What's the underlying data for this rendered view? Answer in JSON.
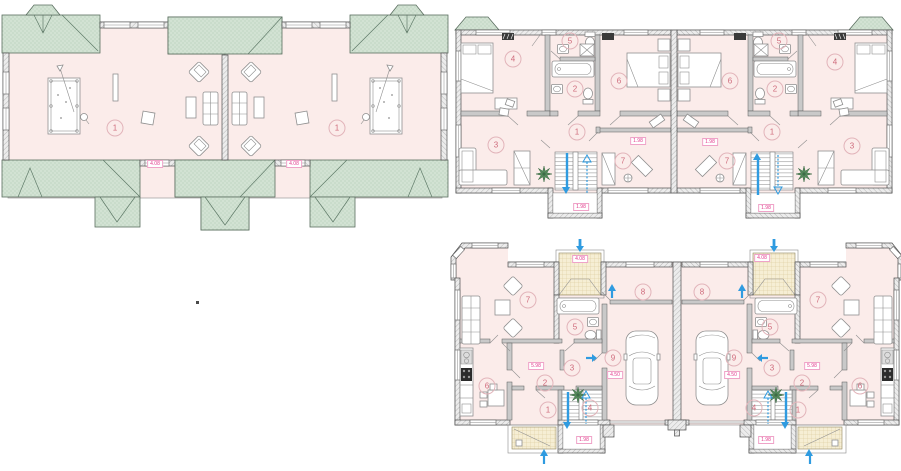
{
  "colors": {
    "floor_pink": "#fbecea",
    "roof_green": "#d2e2d3",
    "porch_beige": "#f6eed4",
    "wall_gray": "#ececec",
    "accent_pink": "#e23a8c",
    "room_number_pink": "#cf6b7c",
    "accent_blue": "#2f9be0",
    "plant_green": "#55895b"
  },
  "plans": {
    "attic": {
      "rooms": [
        {
          "n": "1",
          "x": 115,
          "y": 128
        },
        {
          "n": "1",
          "x": 337,
          "y": 128
        }
      ],
      "labels": [
        {
          "t": "4.08",
          "x": 155,
          "y": 164
        },
        {
          "t": "4.08",
          "x": 294,
          "y": 164
        }
      ]
    },
    "second_floor": {
      "rooms": [
        {
          "n": "4",
          "x": 513,
          "y": 59
        },
        {
          "n": "5",
          "x": 570,
          "y": 41
        },
        {
          "n": "2",
          "x": 575,
          "y": 89
        },
        {
          "n": "6",
          "x": 619,
          "y": 81
        },
        {
          "n": "3",
          "x": 496,
          "y": 145
        },
        {
          "n": "1",
          "x": 577,
          "y": 132
        },
        {
          "n": "7",
          "x": 623,
          "y": 161
        },
        {
          "n": "6",
          "x": 730,
          "y": 81
        },
        {
          "n": "5",
          "x": 779,
          "y": 41
        },
        {
          "n": "2",
          "x": 775,
          "y": 89
        },
        {
          "n": "4",
          "x": 835,
          "y": 62
        },
        {
          "n": "1",
          "x": 772,
          "y": 132
        },
        {
          "n": "7",
          "x": 727,
          "y": 161
        },
        {
          "n": "3",
          "x": 852,
          "y": 146
        }
      ],
      "labels": [
        {
          "t": "1.98",
          "x": 638,
          "y": 141
        },
        {
          "t": "1.98",
          "x": 581,
          "y": 207
        },
        {
          "t": "1.98",
          "x": 710,
          "y": 142
        },
        {
          "t": "1.98",
          "x": 766,
          "y": 208
        }
      ]
    },
    "first_floor": {
      "rooms": [
        {
          "n": "7",
          "x": 528,
          "y": 300
        },
        {
          "n": "8",
          "x": 643,
          "y": 292
        },
        {
          "n": "5",
          "x": 575,
          "y": 327
        },
        {
          "n": "9",
          "x": 613,
          "y": 358
        },
        {
          "n": "3",
          "x": 572,
          "y": 368
        },
        {
          "n": "2",
          "x": 545,
          "y": 383
        },
        {
          "n": "1",
          "x": 548,
          "y": 410
        },
        {
          "n": "4",
          "x": 590,
          "y": 408
        },
        {
          "n": "6",
          "x": 487,
          "y": 386
        },
        {
          "n": "8",
          "x": 702,
          "y": 292
        },
        {
          "n": "7",
          "x": 818,
          "y": 300
        },
        {
          "n": "5",
          "x": 770,
          "y": 327
        },
        {
          "n": "9",
          "x": 734,
          "y": 358
        },
        {
          "n": "3",
          "x": 772,
          "y": 368
        },
        {
          "n": "2",
          "x": 802,
          "y": 383
        },
        {
          "n": "6",
          "x": 860,
          "y": 386
        },
        {
          "n": "4",
          "x": 754,
          "y": 408
        },
        {
          "n": "1",
          "x": 798,
          "y": 410
        }
      ],
      "labels": [
        {
          "t": "4.08",
          "x": 580,
          "y": 259
        },
        {
          "t": "5.98",
          "x": 536,
          "y": 366
        },
        {
          "t": "4.50",
          "x": 615,
          "y": 375
        },
        {
          "t": "1.98",
          "x": 584,
          "y": 440
        },
        {
          "t": "4.08",
          "x": 762,
          "y": 258
        },
        {
          "t": "4.50",
          "x": 732,
          "y": 375
        },
        {
          "t": "5.98",
          "x": 812,
          "y": 366
        },
        {
          "t": "1.98",
          "x": 766,
          "y": 440
        }
      ]
    }
  }
}
